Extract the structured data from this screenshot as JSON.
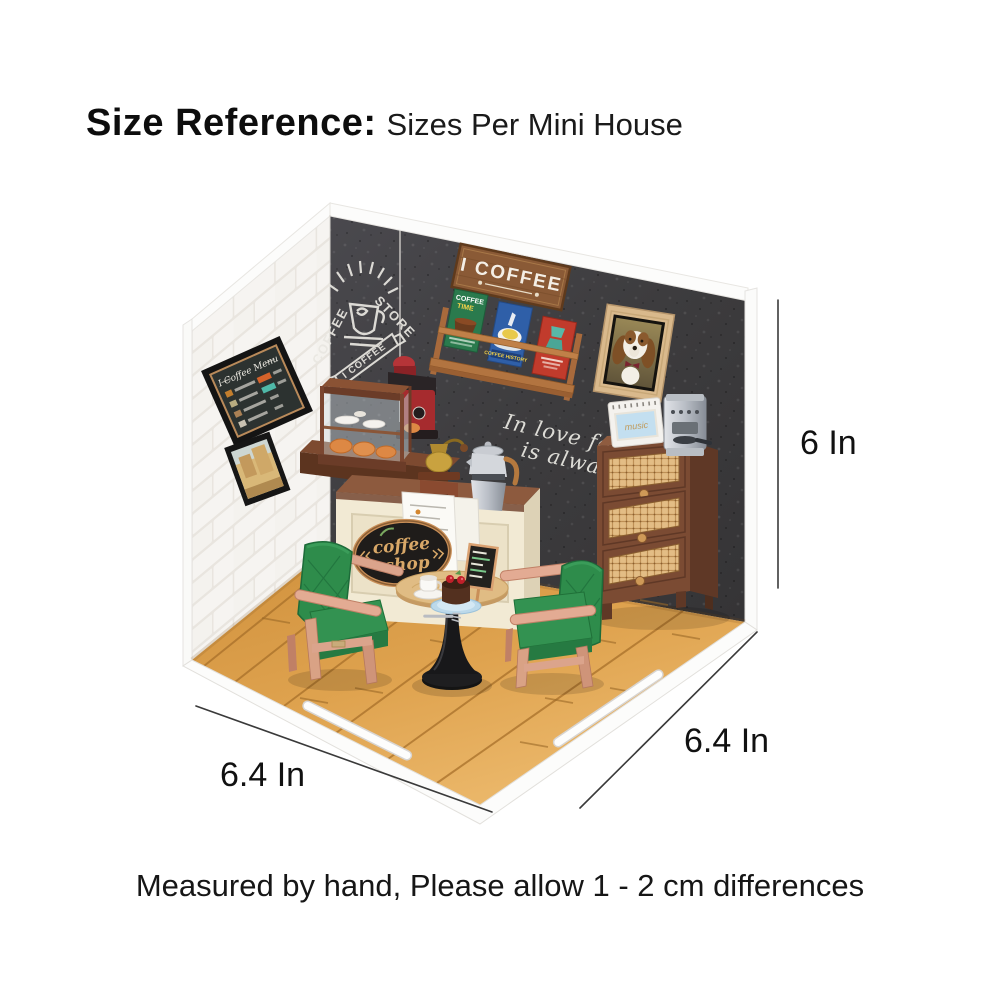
{
  "header": {
    "title": "Size Reference",
    "colon": ":",
    "subtitle": "Sizes Per Mini House"
  },
  "dimensions": {
    "height_label": "6 In",
    "width_label": "6.4 In",
    "depth_label": "6.4 In"
  },
  "footer": {
    "note": "Measured by hand, Please allow 1 - 2 cm differences"
  },
  "scene": {
    "wall_sign_text": "I COFFEE",
    "chalk": {
      "word1": "COFFEE",
      "word2": "STORE",
      "banner": "I COFFEE"
    },
    "menu_board_title": "I Coffee Menu",
    "posters": {
      "green_line1": "COFFEE",
      "green_line2": "TIME",
      "blue_caption": "COFFEE HISTORY"
    },
    "quote": {
      "line1": "In love folly",
      "line2": "is always s"
    },
    "shop_sign": {
      "line1": "coffee",
      "line2": "shop"
    },
    "radio_label": "music",
    "colors": {
      "wall_dark": "#3d3c3e",
      "wall_brick": "#f6f4f1",
      "floor_wood": "#dfa34f",
      "chair_green": "#2e8c4b",
      "chair_wood": "#dba48c",
      "cabinet_brown": "#7b4b33",
      "rattan": "#dcb67e",
      "counter_cream": "#f2ead4",
      "counter_top": "#8d5a3e",
      "sign_wood": "#8a5a36",
      "poster_green": "#2a7a4d",
      "poster_blue": "#2f5fa8",
      "poster_red": "#c13b2c",
      "radio_screen": "#c3dff0",
      "table_wood": "#e0bc84",
      "machine_red": "#a62b2e",
      "dim_line": "#3a3a3a"
    }
  }
}
